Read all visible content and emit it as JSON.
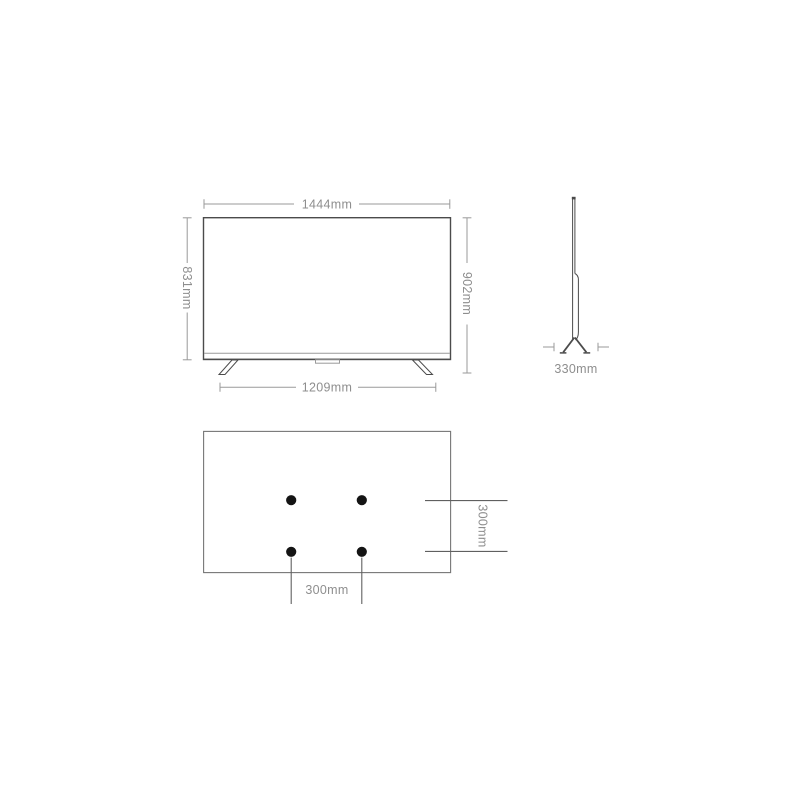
{
  "colors": {
    "background": "#ffffff",
    "outline_dark": "#4b4b4b",
    "outline_medium": "#757575",
    "dim_line": "#9a9a9a",
    "rear_dim_line": "#606060",
    "label_text": "#8e8e8e",
    "vesa_dot": "#141414"
  },
  "front_view": {
    "width_label": "1444mm",
    "screen_height_label": "831mm",
    "overall_height_label": "902mm",
    "stand_span_label": "1209mm"
  },
  "side_view": {
    "base_depth_label": "330mm"
  },
  "rear_view": {
    "vesa_vertical_spacing_label": "300mm",
    "vesa_horizontal_spacing_label": "300mm"
  }
}
